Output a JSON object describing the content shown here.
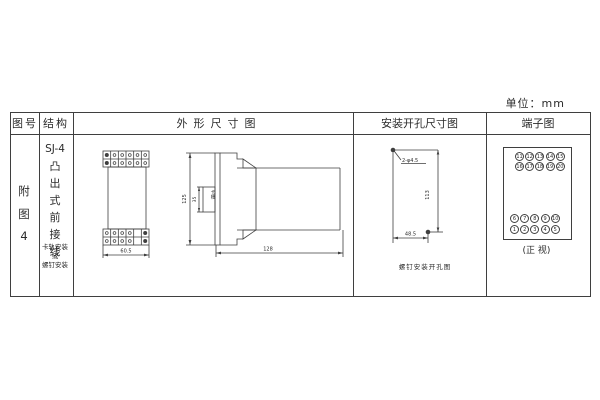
{
  "unit_label": "单位：mm",
  "colors": {
    "ink": "#3f3f3f",
    "background": "#ffffff"
  },
  "table": {
    "headers": {
      "col1": "图号",
      "col2": "结构",
      "col3": "外形尺寸图",
      "col4": "安装开孔尺寸图",
      "col5": "端子图"
    }
  },
  "figure": {
    "chars": [
      "附",
      "图",
      "4"
    ]
  },
  "structure": {
    "model": "SJ-4",
    "type_chars": [
      "凸",
      "出",
      "式",
      "前",
      "接",
      "线"
    ],
    "mount_note": [
      "卡轨安装",
      "或",
      "螺钉安装"
    ]
  },
  "outline": {
    "front_width": "60.5",
    "height": "125",
    "slot_dim": "35",
    "slot_label": "卡槽",
    "depth": "128"
  },
  "mounting": {
    "holes_label": "2-φ4.5",
    "v_dim": "113",
    "h_dim": "48.5",
    "caption": "螺钉安装开孔图"
  },
  "terminals": {
    "upper": [
      [
        "11",
        "12",
        "13",
        "14",
        "15"
      ],
      [
        "16",
        "17",
        "18",
        "19",
        "20"
      ]
    ],
    "lower": [
      [
        "6",
        "7",
        "8",
        "9",
        "10"
      ],
      [
        "1",
        "2",
        "3",
        "4",
        "5"
      ]
    ],
    "caption": "(正 视)"
  }
}
